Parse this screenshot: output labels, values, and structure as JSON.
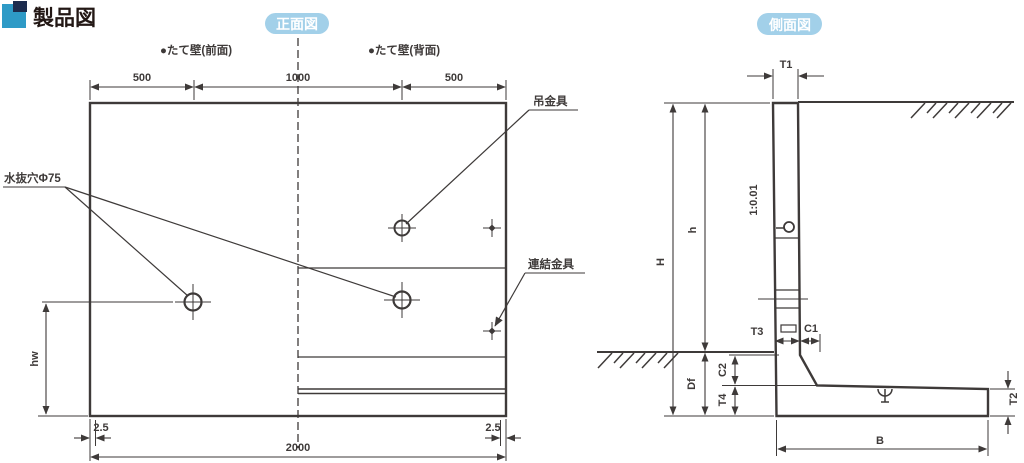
{
  "page": {
    "title": "製品図"
  },
  "front_view": {
    "badge": "正面図",
    "wall_front_label": "●たて壁(前面)",
    "wall_back_label": "●たて壁(背面)",
    "drain_hole_label": "水抜穴Φ75",
    "lifting_hw_label": "吊金具",
    "connecting_hw_label": "連結金具",
    "dim_500_left": "500",
    "dim_1000": "1000",
    "dim_500_right": "500",
    "dim_2000": "2000",
    "dim_25_left": "2.5",
    "dim_25_right": "2.5",
    "dim_hw": "hw"
  },
  "side_view": {
    "badge": "側面図",
    "slope_label": "1:0.01",
    "dim_T1": "T1",
    "dim_H": "H",
    "dim_h": "h",
    "dim_Df": "Df",
    "dim_C2": "C2",
    "dim_T4": "T4",
    "dim_T3": "T3",
    "dim_C1": "C1",
    "dim_T2": "T2",
    "dim_B": "B"
  },
  "colors": {
    "line": "#3e3a39",
    "badge_bg": "#a2d0e9",
    "badge_text": "#ffffff",
    "logo_blue": "#2e9ac6",
    "logo_navy": "#1c2c4e"
  }
}
